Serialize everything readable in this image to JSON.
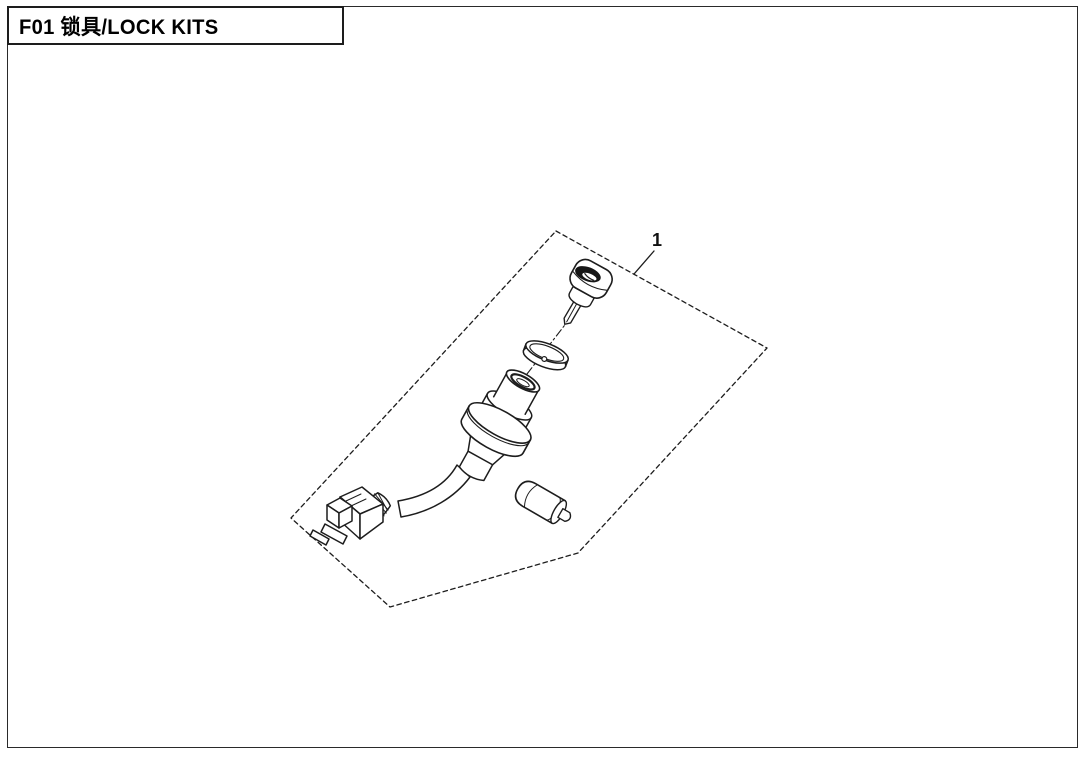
{
  "header": {
    "title": "F01 锁具/LOCK KITS"
  },
  "figure": {
    "callout_number": "1",
    "kit_name": "lock kit exploded view",
    "components": [
      "ignition key",
      "lock ring washer",
      "ignition switch cylinder",
      "wiring cable with connector",
      "lock barrel"
    ]
  },
  "colors": {
    "line": "#1d1d1d",
    "background": "#ffffff"
  }
}
